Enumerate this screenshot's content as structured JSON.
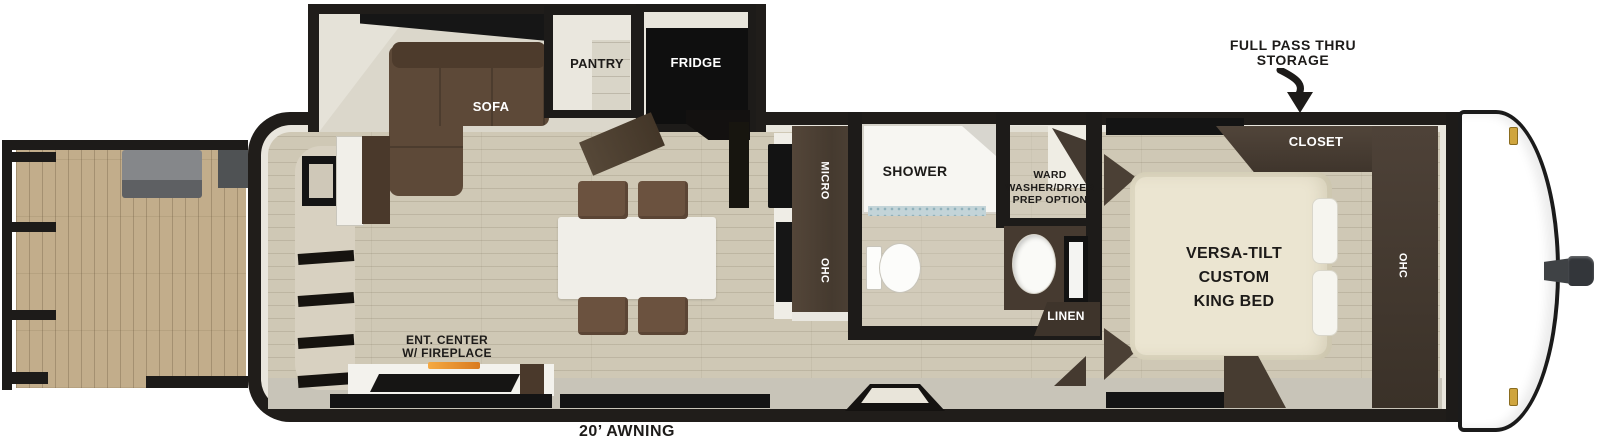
{
  "colors": {
    "wall_black": "#201d1a",
    "floor_tan": "#cfc8b5",
    "deck_wood": "#c2ad8b",
    "wood_dark": "#4a3e33",
    "sofa_brown": "#5d4938",
    "bed_ivory": "#ebe5d1",
    "fireplace_glow": "#e8882a",
    "marker_light_gold": "#cfa53e"
  },
  "labels": {
    "storage": {
      "line1": "FULL PASS THRU",
      "line2": "STORAGE"
    },
    "sofa": "SOFA",
    "pantry": "PANTRY",
    "fridge": "FRIDGE",
    "micro": "MICRO",
    "kitchen_ohc": "OHC",
    "shower": "SHOWER",
    "ward": {
      "line1": "WARD",
      "line2": "WASHER/DRYER",
      "line3": "PREP OPTION"
    },
    "linen": "LINEN",
    "closet": "CLOSET",
    "bedroom_ohc": "OHC",
    "king_bed": {
      "line1": "VERSA-TILT",
      "line2": "CUSTOM",
      "line3": "KING BED"
    },
    "ent_center": {
      "line1": "ENT. CENTER",
      "line2": "W/ FIREPLACE"
    },
    "awning": "20’ AWNING"
  }
}
